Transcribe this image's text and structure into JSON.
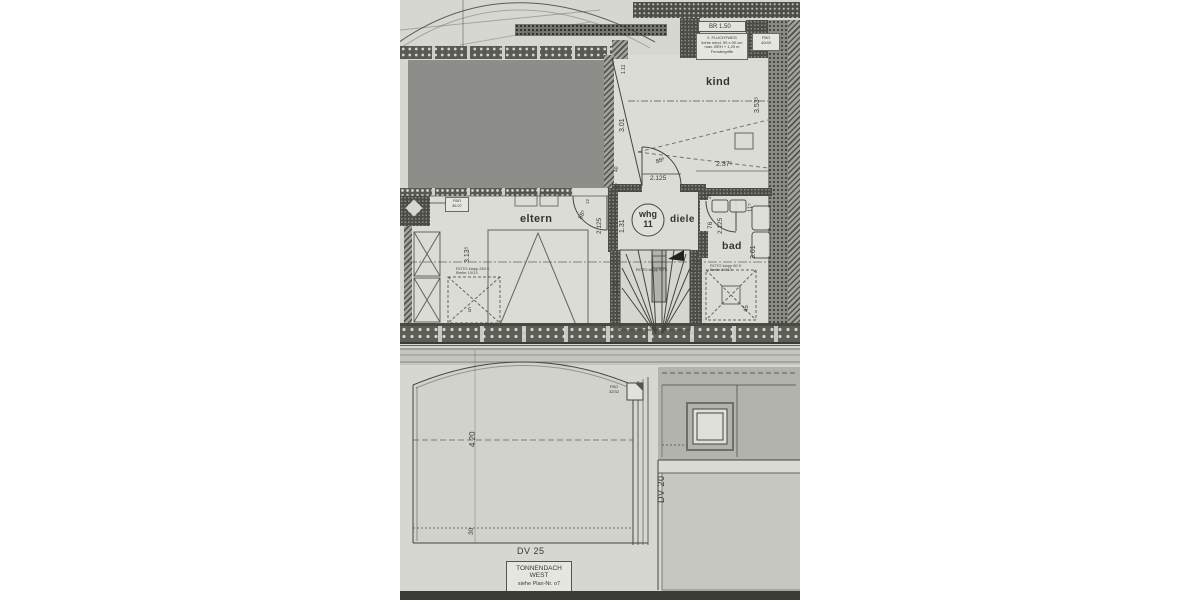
{
  "palette": {
    "paper": "#d7d7d2",
    "room_fill": "#dcdcd6",
    "ink": "#46463f",
    "blanked_unit_gray": "#8d8d8a",
    "roof_dark_gray": "#b3b3ae",
    "scan_edge_dark": "#3b3b37"
  },
  "floor_plan": {
    "rooms": {
      "eltern": "eltern",
      "kind": "kind",
      "diele": "diele",
      "bad": "bad"
    },
    "unit": {
      "line1": "whg",
      "line2": "11"
    },
    "window": {
      "header": "BR 1.50",
      "note_line1": "2. FLUCHTWEG",
      "note_line2": "lichte mind. 90 x 90 cm",
      "note_line3": "max. BRH + 1,20 m",
      "note_line4": "Fenstergriffe"
    },
    "tags": {
      "fbo_kind_l1": "FBO",
      "fbo_kind_l2": "40/40",
      "fbo_eltern_l1": "FBO",
      "fbo_eltern_l2": "36.07",
      "roto_eltern_l1": "ROTO klapp 260 K",
      "roto_eltern_l2": "Breite 10/13",
      "roto_bad_l1": "ROTO klapp 80 K",
      "roto_bad_l2": "Breite 10/13",
      "stair_note": "ROTO klapp 60 K"
    },
    "dims": {
      "kind_h": "3.01",
      "kind_top": "1.11",
      "kind_shelf": "3.53⁵",
      "kind_w": "2.37⁵",
      "kind_door_w": "88⁵",
      "kind_door_h": "2.125",
      "kind_jamb_a": "40",
      "kind_jamb_b": "11⁵",
      "eltern_h": "3.13⁵",
      "eltern_door_w": "88⁵",
      "eltern_door_h": "2.125",
      "eltern_top": "12",
      "eltern_b": "5",
      "diele_w": "1.31",
      "stair_l": "1.70",
      "bad_door_top": "26",
      "bad_door_w": "76",
      "bad_door_h": "2.125",
      "bad_top": "11⁵",
      "bad_h": "3.01",
      "bad_b": "45"
    }
  },
  "roof_plan": {
    "dims": {
      "panel_h": "4.20",
      "panel_b": "30"
    },
    "labels": {
      "dv25": "DV 25",
      "dv20": "DV 20",
      "fbo_l1": "FBO",
      "fbo_l2": "32/32"
    },
    "title": {
      "line1": "TONNENDACH",
      "line2": "WEST",
      "line3": "siehe Plan-Nr. o7"
    }
  }
}
